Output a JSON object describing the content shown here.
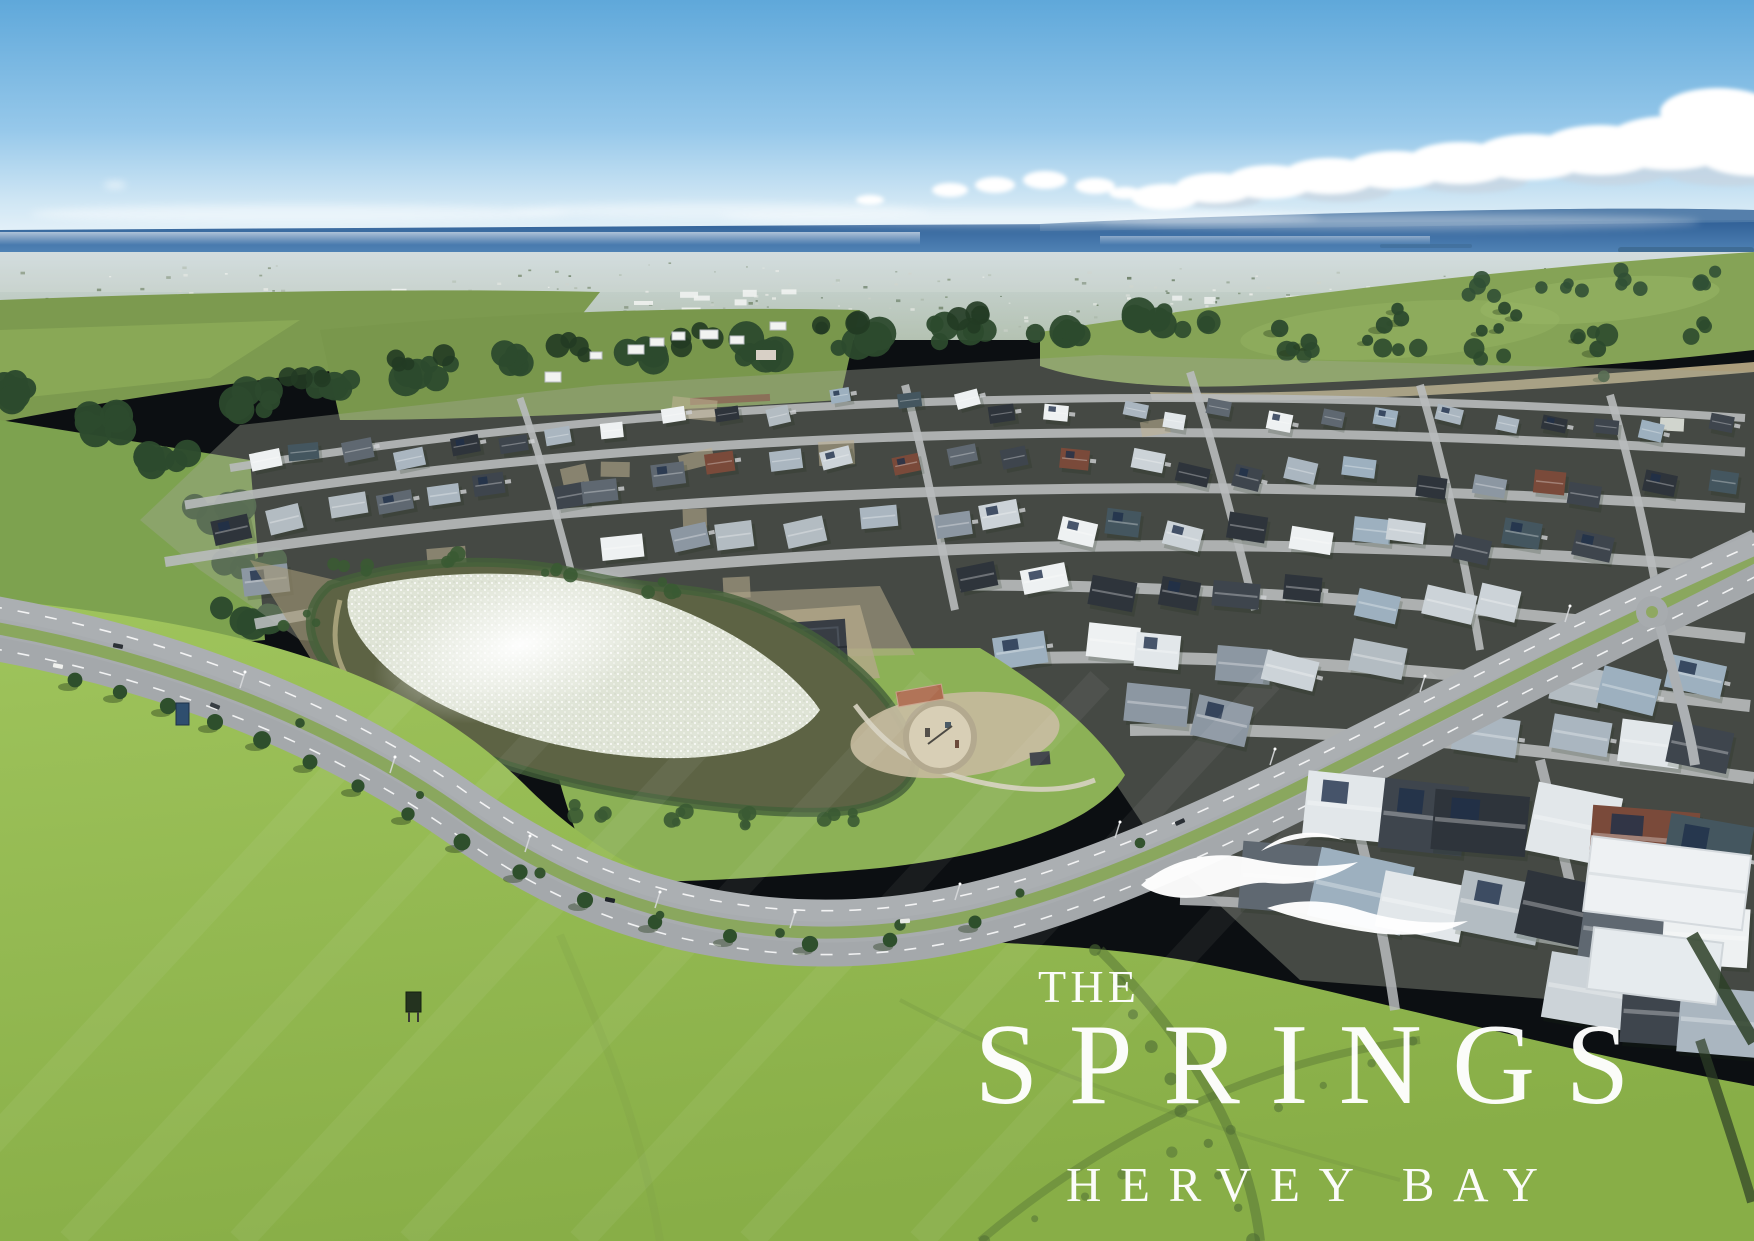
{
  "logo": {
    "line1": "THE",
    "name": "SPRINGS",
    "location": "HERVEY BAY",
    "color": "#ffffff",
    "icon": "triple-wave-icon"
  },
  "photo": {
    "title": "Aerial view of The Springs residential estate, Hervey Bay, with lake, parkland, curving boulevard, distant town and ocean horizon",
    "palette": {
      "sky_top": "#5fa8da",
      "sky_horizon": "#e6f2f9",
      "ocean": "#2f5f96",
      "ocean_light": "#5b8fc0",
      "cloud": "#ffffff",
      "town_haze": "#c8d4d6",
      "hill": "#7c9a4f",
      "pasture": "#85a356",
      "tree": "#2c4a2d",
      "tree_dark": "#223b24",
      "field_light": "#9fc45c",
      "field": "#88ae47",
      "lake": "#5d6344",
      "lake_glint": "#e3e7da",
      "road": "#a8acaf",
      "street": "#b8bbbd",
      "dirt": "#c0b294",
      "logo_white": "#ffffff",
      "roofs": [
        "#eef1f2",
        "#e2e7ea",
        "#ccd3d8",
        "#aab6c0",
        "#8c97a2",
        "#5f6871",
        "#3e454d",
        "#2e343b",
        "#9db0bf",
        "#b3bcc2",
        "#7a4a3a",
        "#44565f"
      ]
    }
  }
}
